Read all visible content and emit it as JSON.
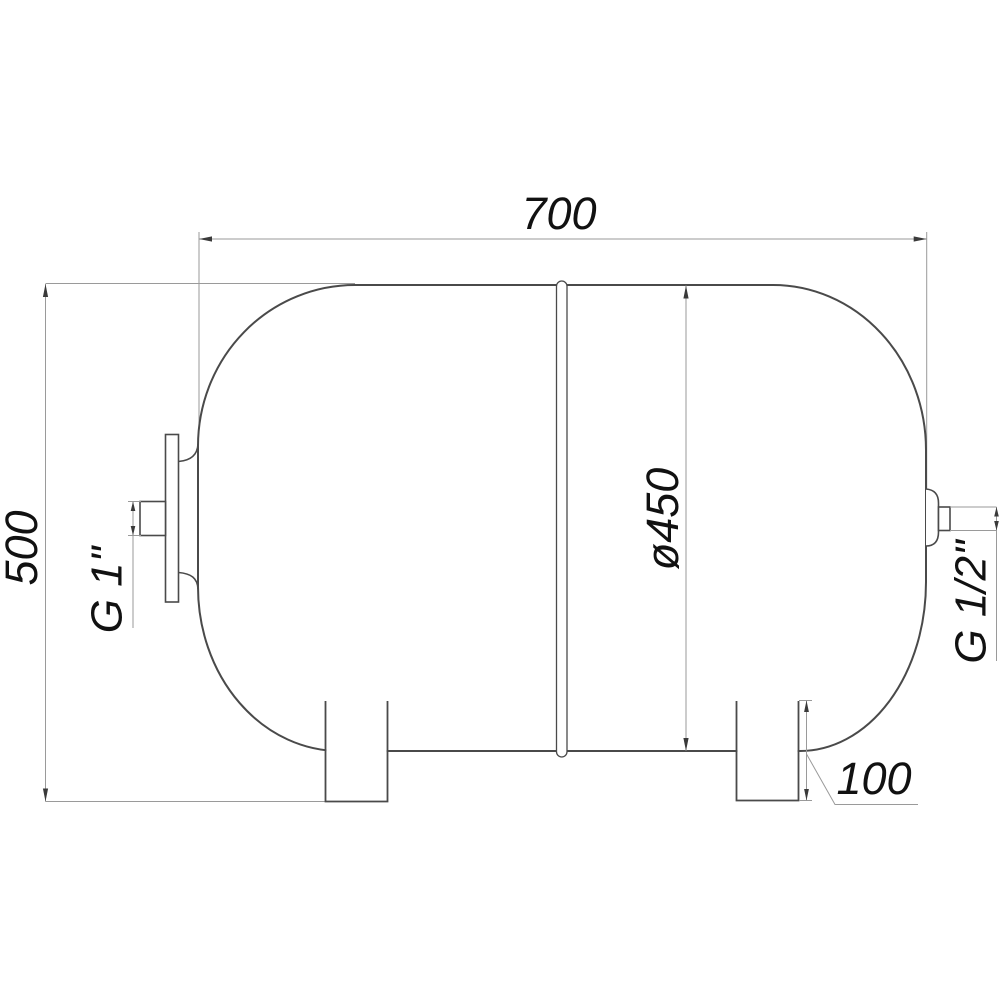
{
  "drawing": {
    "kind": "technical-drawing",
    "subject": "horizontal-tank-side-view",
    "colors": {
      "outline": "#4a4a4a",
      "dimension_lines": "#9a9a9a",
      "text": "#111111",
      "background": "#ffffff"
    },
    "labels": {
      "overall_width": "700",
      "overall_height": "500",
      "diameter": "ø450",
      "left_connection": "G 1\"",
      "right_connection": "G 1/2\"",
      "leg_height": "100"
    }
  }
}
